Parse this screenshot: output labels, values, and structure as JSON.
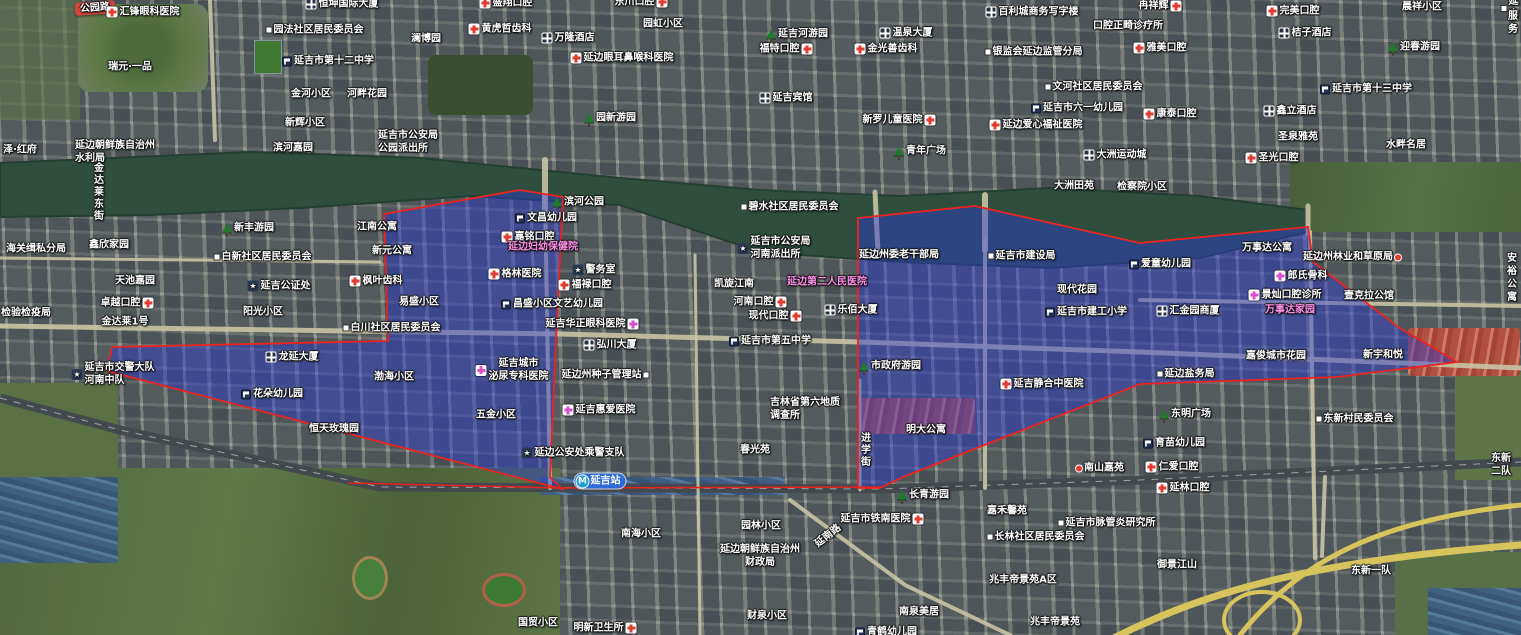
{
  "map": {
    "width": 1521,
    "height": 635,
    "colors": {
      "overlay_fill": "#2d3cd2",
      "overlay_fill_opacity": 0.45,
      "overlay_stroke": "#ee2320",
      "water": "#2f4e3e",
      "road": "#c9c3a4",
      "highway": "#d8c45c",
      "railway": "#44494e",
      "railway_red": "#e8241e",
      "label_white": "#ffffff",
      "label_pink": "#ff8fe8",
      "metro_blue": "#2e6bd8",
      "road_ribbon_red": "#d2453a"
    },
    "geometry": {
      "river": "M0,163 L250,152 L420,158 L620,178 L760,190 L900,196 L1050,188 L1200,196 L1308,210 L1308,232 L1200,258 L1050,268 L900,262 L760,252 L620,205 L470,196 L300,208 L150,215 L0,217 Z",
      "roads": [
        {
          "p": "0,326 560,334 860,342 1140,352 1521,368",
          "w": 5
        },
        {
          "p": "0,258 380,262",
          "w": 3
        },
        {
          "p": "1140,300 1521,306",
          "w": 4
        },
        {
          "p": "210,0 215,140",
          "w": 4
        },
        {
          "p": "545,195 550,488",
          "w": 4
        },
        {
          "p": "985,240 985,488",
          "w": 4
        },
        {
          "p": "860,380 860,490",
          "w": 3
        },
        {
          "p": "1310,232 1315,558",
          "w": 4
        },
        {
          "p": "695,255 700,635",
          "w": 3
        },
        {
          "p": "790,500 905,585 1010,635",
          "w": 4
        },
        {
          "p": "1325,477 1322,556",
          "w": 4
        },
        {
          "p": "545,160 545,215",
          "w": 6
        },
        {
          "p": "875,192 878,252",
          "w": 5
        },
        {
          "p": "985,195 985,250",
          "w": 6
        },
        {
          "p": "1308,206 1308,234",
          "w": 5
        }
      ],
      "highways": [
        {
          "d": "M1095,648 C1200,590 1320,560 1521,545",
          "w": 7
        },
        {
          "d": "M1521,505 C1380,520 1300,560 1240,635",
          "w": 5
        },
        {
          "d": "M1224,620 a38,28 0 1 0 76,0 a38,28 0 1 0 -76,0",
          "w": 4
        }
      ],
      "railway": {
        "p": "0,398 120,430 380,487 880,489 1140,480 1521,462",
        "w": 9
      },
      "railway_red": "348,483 560,488 882,487",
      "overlays": [
        {
          "name": "district-overlay-west",
          "points": "107,371 112,347 388,341 384,214 520,190 563,197 556,340 550,477 562,489"
        },
        {
          "name": "district-overlay-east",
          "points": "858,218 975,206 1140,243 1308,227 1313,262 1398,327 1457,362 1337,377 1140,384 903,477 880,488 858,488"
        }
      ]
    },
    "labels": [
      {
        "t": "公园路",
        "x": 95,
        "y": 8,
        "c": "roadred",
        "r": -4
      },
      {
        "t": "汇锋眼科医院",
        "x": 143,
        "y": 12,
        "i": "cross"
      },
      {
        "t": "恒坤国际大厦",
        "x": 342,
        "y": 4,
        "i": "building"
      },
      {
        "t": "盛翔口腔",
        "x": 506,
        "y": 3,
        "i": "cross"
      },
      {
        "t": "东川口腔",
        "x": 641,
        "y": 2,
        "i": "cross",
        "s": "r"
      },
      {
        "t": "园法社区居民委员会",
        "x": 315,
        "y": 30,
        "i": "dot"
      },
      {
        "t": "百利城商务写字楼",
        "x": 1032,
        "y": 12,
        "i": "building"
      },
      {
        "t": "冉祥辉",
        "x": 1160,
        "y": 6,
        "i": "cross",
        "s": "r"
      },
      {
        "t": "口腔正畸诊疗所",
        "x": 1128,
        "y": 26
      },
      {
        "t": "雅美口腔",
        "x": 1160,
        "y": 48,
        "i": "cross"
      },
      {
        "t": "完美口腔",
        "x": 1293,
        "y": 11,
        "i": "cross"
      },
      {
        "t": "晨祥小区",
        "x": 1422,
        "y": 7
      },
      {
        "t": "桔子酒店",
        "x": 1305,
        "y": 33,
        "i": "building"
      },
      {
        "t": "延吉",
        "x": 1510,
        "y": 8,
        "i": "dot"
      },
      {
        "t": "服务",
        "x": 1513,
        "y": 23
      },
      {
        "t": "迎春游园",
        "x": 1414,
        "y": 47,
        "i": "park"
      },
      {
        "t": "澜博园",
        "x": 426,
        "y": 39
      },
      {
        "t": "黄虎哲齿科",
        "x": 500,
        "y": 29,
        "i": "cross"
      },
      {
        "t": "万隆酒店",
        "x": 568,
        "y": 38,
        "i": "building"
      },
      {
        "t": "延边眼耳鼻喉科医院",
        "x": 622,
        "y": 58,
        "i": "cross"
      },
      {
        "t": "园虹小区",
        "x": 663,
        "y": 24
      },
      {
        "t": "延吉河游园",
        "x": 797,
        "y": 34,
        "i": "park"
      },
      {
        "t": "福特口腔",
        "x": 786,
        "y": 49,
        "i": "cross",
        "s": "r"
      },
      {
        "t": "温泉大厦",
        "x": 906,
        "y": 33,
        "i": "building"
      },
      {
        "t": "金光善齿科",
        "x": 886,
        "y": 49,
        "i": "cross"
      },
      {
        "t": "银监会延边监管分局",
        "x": 1034,
        "y": 52,
        "i": "dot"
      },
      {
        "t": "延吉宾馆",
        "x": 786,
        "y": 98,
        "i": "building"
      },
      {
        "t": "文河社区居民委员会",
        "x": 1094,
        "y": 87,
        "i": "dot"
      },
      {
        "t": "新罗儿童医院",
        "x": 899,
        "y": 120,
        "i": "cross",
        "s": "r"
      },
      {
        "t": "延吉市六一幼儿园",
        "x": 1077,
        "y": 108,
        "i": "school"
      },
      {
        "t": "延边爱心福祉医院",
        "x": 1036,
        "y": 125,
        "i": "cross"
      },
      {
        "t": "康泰口腔",
        "x": 1170,
        "y": 114,
        "i": "cross"
      },
      {
        "t": "延吉市第十三中学",
        "x": 1366,
        "y": 89,
        "i": "school"
      },
      {
        "t": "鑫立酒店",
        "x": 1290,
        "y": 111,
        "i": "building"
      },
      {
        "t": "圣泉雅苑",
        "x": 1298,
        "y": 137
      },
      {
        "t": "水畔名居",
        "x": 1406,
        "y": 145
      },
      {
        "t": "圣光口腔",
        "x": 1272,
        "y": 158,
        "i": "cross"
      },
      {
        "t": "延吉市第十二中学",
        "x": 328,
        "y": 61,
        "i": "school"
      },
      {
        "t": "金河小区",
        "x": 311,
        "y": 94
      },
      {
        "t": "河畔花园",
        "x": 367,
        "y": 94
      },
      {
        "t": "瑞元·一品",
        "x": 130,
        "y": 67
      },
      {
        "t": "新辉小区",
        "x": 305,
        "y": 123
      },
      {
        "t": "滨河嘉园",
        "x": 293,
        "y": 148
      },
      {
        "t": "延边朝鲜族自治州\n水利局",
        "x": 115,
        "y": 152,
        "ta": "left"
      },
      {
        "t": "泽·红府",
        "x": 20,
        "y": 150
      },
      {
        "t": "延吉市公安局\n公园派出所",
        "x": 408,
        "y": 142,
        "ta": "left"
      },
      {
        "t": "园新游园",
        "x": 610,
        "y": 118,
        "i": "park"
      },
      {
        "t": "青年广场",
        "x": 920,
        "y": 151,
        "i": "park"
      },
      {
        "t": "大洲运动城",
        "x": 1115,
        "y": 155,
        "i": "building"
      },
      {
        "t": "大洲田苑",
        "x": 1074,
        "y": 186
      },
      {
        "t": "检察院小区",
        "x": 1142,
        "y": 187
      },
      {
        "t": "金达莱东街",
        "x": 97,
        "y": 192,
        "m": "v"
      },
      {
        "t": "新丰游园",
        "x": 248,
        "y": 228,
        "i": "park"
      },
      {
        "t": "鑫欣家园",
        "x": 109,
        "y": 245
      },
      {
        "t": "海关缉私分局",
        "x": 36,
        "y": 249
      },
      {
        "t": "白新社区居民委员会",
        "x": 263,
        "y": 257,
        "i": "dot"
      },
      {
        "t": "江南公寓",
        "x": 377,
        "y": 227
      },
      {
        "t": "新元公寓",
        "x": 392,
        "y": 251
      },
      {
        "t": "天池嘉园",
        "x": 135,
        "y": 281
      },
      {
        "t": "延吉公证处",
        "x": 279,
        "y": 286,
        "i": "star"
      },
      {
        "t": "枫叶齿科",
        "x": 376,
        "y": 281,
        "i": "cross"
      },
      {
        "t": "卓越口腔",
        "x": 127,
        "y": 303,
        "i": "cross",
        "s": "r"
      },
      {
        "t": "阳光小区",
        "x": 263,
        "y": 312
      },
      {
        "t": "检验检疫局",
        "x": 26,
        "y": 313
      },
      {
        "t": "滨河公园",
        "x": 578,
        "y": 202,
        "i": "park"
      },
      {
        "t": "文昌幼儿园",
        "x": 546,
        "y": 218,
        "i": "school"
      },
      {
        "t": "嘉铭口腔",
        "x": 528,
        "y": 237,
        "i": "cross"
      },
      {
        "t": "延边妇幼保健院",
        "x": 543,
        "y": 247,
        "c": "pink"
      },
      {
        "t": "格林医院",
        "x": 515,
        "y": 274,
        "i": "cross"
      },
      {
        "t": "警务室",
        "x": 594,
        "y": 270,
        "i": "star"
      },
      {
        "t": "福禄口腔",
        "x": 585,
        "y": 285,
        "i": "cross"
      },
      {
        "t": "昌盛小区文艺幼儿园",
        "x": 552,
        "y": 304,
        "i": "school"
      },
      {
        "t": "易盛小区",
        "x": 419,
        "y": 302
      },
      {
        "t": "碧水社区居民委员会",
        "x": 790,
        "y": 207,
        "i": "dot"
      },
      {
        "t": "延吉市公安局\n河南派出所",
        "x": 774,
        "y": 248,
        "i": "star",
        "ta": "left"
      },
      {
        "t": "延边州委老干部局",
        "x": 899,
        "y": 255
      },
      {
        "t": "延吉市建设局",
        "x": 1022,
        "y": 256,
        "i": "dot"
      },
      {
        "t": "延边第二人民医院",
        "x": 827,
        "y": 282,
        "c": "pink"
      },
      {
        "t": "现代花园",
        "x": 1077,
        "y": 290
      },
      {
        "t": "延吉市建工小学",
        "x": 1086,
        "y": 312,
        "i": "school"
      },
      {
        "t": "乐佰大厦",
        "x": 851,
        "y": 310,
        "i": "building"
      },
      {
        "t": "现代口腔",
        "x": 775,
        "y": 316,
        "i": "cross",
        "s": "r"
      },
      {
        "t": "河南口腔",
        "x": 760,
        "y": 302,
        "i": "cross",
        "s": "r"
      },
      {
        "t": "凯旋江南",
        "x": 734,
        "y": 284
      },
      {
        "t": "万事达公寓",
        "x": 1267,
        "y": 248
      },
      {
        "t": "爱童幼儿园",
        "x": 1160,
        "y": 264,
        "i": "school"
      },
      {
        "t": "延边州林业和草原局",
        "x": 1352,
        "y": 257,
        "i": "reddot",
        "s": "r"
      },
      {
        "t": "郎氏骨科",
        "x": 1301,
        "y": 276,
        "i": "crossp"
      },
      {
        "t": "景灿口腔诊所",
        "x": 1285,
        "y": 295,
        "i": "crossp"
      },
      {
        "t": "万事达家园",
        "x": 1290,
        "y": 310,
        "c": "pink"
      },
      {
        "t": "壹克拉公馆",
        "x": 1369,
        "y": 296
      },
      {
        "t": "汇金园商厦",
        "x": 1188,
        "y": 311,
        "i": "building"
      },
      {
        "t": "安裕公寓",
        "x": 1512,
        "y": 278
      },
      {
        "t": "东明广场",
        "x": 1185,
        "y": 414,
        "i": "park"
      },
      {
        "t": "金达莱1号",
        "x": 125,
        "y": 322
      },
      {
        "t": "白川社区居民委员会",
        "x": 392,
        "y": 328,
        "i": "dot"
      },
      {
        "t": "延吉市交警大队\n河南中队",
        "x": 113,
        "y": 374,
        "i": "star",
        "ta": "left"
      },
      {
        "t": "龙延大厦",
        "x": 292,
        "y": 357,
        "i": "building"
      },
      {
        "t": "渤海小区",
        "x": 394,
        "y": 377
      },
      {
        "t": "花朵幼儿园",
        "x": 272,
        "y": 394,
        "i": "school"
      },
      {
        "t": "恒天玫瑰园",
        "x": 334,
        "y": 429
      },
      {
        "t": "五金小区",
        "x": 496,
        "y": 415
      },
      {
        "t": "延吉华正眼科医院",
        "x": 592,
        "y": 324,
        "i": "crossp",
        "s": "r"
      },
      {
        "t": "弘川大厦",
        "x": 610,
        "y": 345,
        "i": "building"
      },
      {
        "t": "延吉市第五中学",
        "x": 770,
        "y": 341,
        "i": "school"
      },
      {
        "t": "延吉城市\n泌尿专科医院",
        "x": 512,
        "y": 370,
        "i": "crossp",
        "ta": "center"
      },
      {
        "t": "延边州种子管理站",
        "x": 605,
        "y": 375,
        "i": "dot",
        "s": "r"
      },
      {
        "t": "延吉惠爱医院",
        "x": 599,
        "y": 410,
        "i": "crossp"
      },
      {
        "t": "延边公安处乘警支队",
        "x": 573,
        "y": 453,
        "i": "star"
      },
      {
        "t": "吉林省第六地质\n调查所",
        "x": 805,
        "y": 409,
        "ta": "left"
      },
      {
        "t": "春光苑",
        "x": 755,
        "y": 450
      },
      {
        "t": "市政府游园",
        "x": 890,
        "y": 366,
        "i": "park"
      },
      {
        "t": "延吉静合中医院",
        "x": 1042,
        "y": 384,
        "i": "cross"
      },
      {
        "t": "明大公寓",
        "x": 926,
        "y": 430
      },
      {
        "t": "进学街",
        "x": 864,
        "y": 450,
        "m": "v"
      },
      {
        "t": "延边盐务局",
        "x": 1186,
        "y": 374,
        "i": "dot"
      },
      {
        "t": "嘉俊城市花园",
        "x": 1276,
        "y": 356
      },
      {
        "t": "新宇和悦",
        "x": 1383,
        "y": 355
      },
      {
        "t": "南山嘉苑",
        "x": 1100,
        "y": 468,
        "i": "reddot"
      },
      {
        "t": "育苗幼儿园",
        "x": 1174,
        "y": 443,
        "i": "school"
      },
      {
        "t": "仁爱口腔",
        "x": 1172,
        "y": 467,
        "i": "cross"
      },
      {
        "t": "东新村民委员会",
        "x": 1355,
        "y": 419,
        "i": "dot"
      },
      {
        "t": "延吉站",
        "x": 600,
        "y": 481,
        "i": "metro",
        "c": "metro"
      },
      {
        "t": "南海小区",
        "x": 641,
        "y": 534
      },
      {
        "t": "园林小区",
        "x": 761,
        "y": 526
      },
      {
        "t": "延边朝鲜族自治州\n财政局",
        "x": 760,
        "y": 556,
        "ta": "center"
      },
      {
        "t": "延南路",
        "x": 828,
        "y": 536,
        "r": -38
      },
      {
        "t": "延吉市铁南医院",
        "x": 882,
        "y": 519,
        "i": "cross",
        "s": "r"
      },
      {
        "t": "长青游园",
        "x": 923,
        "y": 495,
        "i": "park"
      },
      {
        "t": "嘉禾馨苑",
        "x": 1007,
        "y": 511
      },
      {
        "t": "延吉市脉管炎研究所",
        "x": 1107,
        "y": 523,
        "i": "dot"
      },
      {
        "t": "长林社区居民委员会",
        "x": 1036,
        "y": 537,
        "i": "dot"
      },
      {
        "t": "兆丰帝景苑A区",
        "x": 1023,
        "y": 580
      },
      {
        "t": "南泉美居",
        "x": 919,
        "y": 612
      },
      {
        "t": "兆丰帝景苑",
        "x": 1055,
        "y": 622
      },
      {
        "t": "财泉小区",
        "x": 767,
        "y": 616
      },
      {
        "t": "国贸小区",
        "x": 538,
        "y": 623
      },
      {
        "t": "明新卫生所",
        "x": 605,
        "y": 628,
        "i": "cross",
        "s": "r"
      },
      {
        "t": "青鹤幼儿园",
        "x": 886,
        "y": 632,
        "i": "school"
      },
      {
        "t": "延林口腔",
        "x": 1183,
        "y": 488,
        "i": "cross"
      },
      {
        "t": "御景江山",
        "x": 1177,
        "y": 565
      },
      {
        "t": "东新一队",
        "x": 1371,
        "y": 571
      },
      {
        "t": "东新二队",
        "x": 1501,
        "y": 465
      }
    ]
  }
}
